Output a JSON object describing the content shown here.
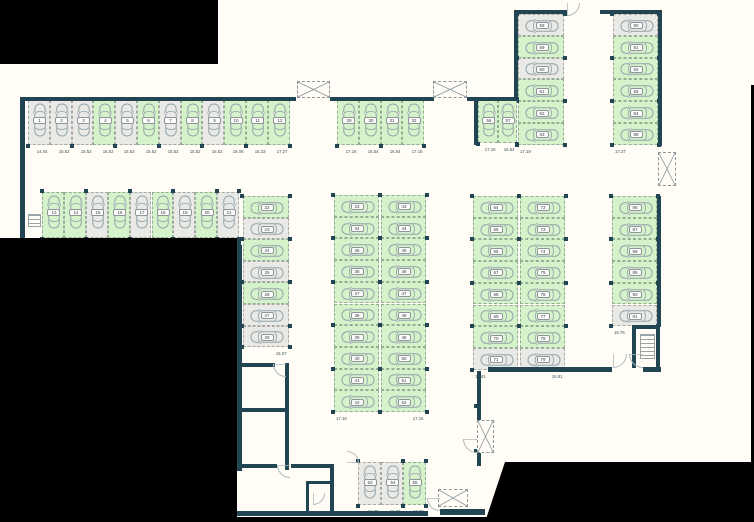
{
  "meta": {
    "canvas_w": 754,
    "canvas_h": 522,
    "description": "underground parking level floor plan"
  },
  "palette": {
    "background": "#fffdf5",
    "wall": "#214552",
    "stall_available_fill": "#d6f2cb",
    "stall_available_border": "#92ae95",
    "stall_taken_fill": "#e9eae6",
    "stall_taken_border": "#a9aaa7",
    "car_outline": "#94a3a9",
    "dimension_text": "#41535d",
    "mask": "#000000"
  },
  "icons": [
    "car-icon",
    "shaft-x-icon",
    "stairs-icon",
    "door-swing-icon"
  ],
  "plan": {
    "groups": [
      {
        "name": "row-1-12",
        "dir": "row",
        "x": 28,
        "y": 100,
        "pitch": 21.8,
        "len": 45,
        "vpos": "b",
        "stalls": [
          [
            "1",
            "14.04",
            0
          ],
          [
            "2",
            "15.52",
            0
          ],
          [
            "3",
            "15.52",
            0
          ],
          [
            "4",
            "15.52",
            1
          ],
          [
            "5",
            "15.52",
            0
          ],
          [
            "6",
            "15.52",
            1
          ],
          [
            "7",
            "15.52",
            0
          ],
          [
            "8",
            "15.52",
            1
          ],
          [
            "9",
            "15.52",
            0
          ],
          [
            "10",
            "16.06",
            1
          ],
          [
            "11",
            "16.33",
            1
          ],
          [
            "12",
            "17.27",
            1
          ]
        ]
      },
      {
        "name": "row-29-32",
        "dir": "row",
        "x": 337,
        "y": 100,
        "pitch": 21.8,
        "len": 45,
        "vpos": "b",
        "stalls": [
          [
            "29",
            "17.16",
            1
          ],
          [
            "30",
            "16.54",
            1
          ],
          [
            "31",
            "16.54",
            1
          ],
          [
            "32",
            "17.16",
            1
          ]
        ]
      },
      {
        "name": "row-13-21",
        "dir": "row",
        "x": 42,
        "y": 192,
        "pitch": 21.9,
        "len": 46,
        "vpos": "b",
        "stalls": [
          [
            "13",
            "20.27",
            1
          ],
          [
            "14",
            "16.67",
            1
          ],
          [
            "15",
            "16.67",
            0
          ],
          [
            "16",
            "16.67",
            1
          ],
          [
            "17",
            "16.67",
            0
          ],
          [
            "18",
            "16.67",
            1
          ],
          [
            "19",
            "16.67",
            0
          ],
          [
            "20",
            "16.67",
            1
          ],
          [
            "21",
            "16.67",
            0
          ]
        ]
      },
      {
        "name": "col-22-28",
        "dir": "col",
        "x": 243,
        "y": 196,
        "pitch": 21.6,
        "len": 46,
        "vpos": "br",
        "stalls": [
          [
            "22",
            "17.16",
            1
          ],
          [
            "23",
            "16.00",
            0
          ],
          [
            "24",
            "16.67",
            1
          ],
          [
            "25",
            "16.67",
            0
          ],
          [
            "26",
            "16.67",
            1
          ],
          [
            "27",
            "16.67",
            0
          ],
          [
            "28",
            "16.07",
            0
          ]
        ]
      },
      {
        "name": "col-33-42",
        "dir": "col",
        "x": 334,
        "y": 195,
        "pitch": 21.7,
        "len": 45,
        "vpos": "bl",
        "stalls": [
          [
            "33",
            "17.16",
            1
          ],
          [
            "34",
            "16.12",
            1
          ],
          [
            "35",
            "16.12",
            1
          ],
          [
            "36",
            "16.12",
            1
          ],
          [
            "37",
            "16.12",
            1
          ],
          [
            "38",
            "16.12",
            1
          ],
          [
            "39",
            "16.12",
            1
          ],
          [
            "40",
            "16.12",
            1
          ],
          [
            "41",
            "16.12",
            1
          ],
          [
            "42",
            "17.16",
            1
          ]
        ]
      },
      {
        "name": "col-43-52",
        "dir": "col",
        "x": 381,
        "y": 195,
        "pitch": 21.7,
        "len": 45,
        "vpos": "br",
        "stalls": [
          [
            "43",
            "17.16",
            1
          ],
          [
            "44",
            "16.12",
            1
          ],
          [
            "45",
            "16.12",
            1
          ],
          [
            "46",
            "16.12",
            1
          ],
          [
            "47",
            "16.12",
            1
          ],
          [
            "48",
            "16.12",
            1
          ],
          [
            "49",
            "16.12",
            1
          ],
          [
            "50",
            "16.12",
            1
          ],
          [
            "51",
            "16.12",
            1
          ],
          [
            "52",
            "17.16",
            1
          ]
        ]
      },
      {
        "name": "col-64-71",
        "dir": "col",
        "x": 473,
        "y": 196,
        "pitch": 21.7,
        "len": 45,
        "vpos": "bl",
        "stalls": [
          [
            "64",
            "17.30",
            1
          ],
          [
            "65",
            "16.12",
            1
          ],
          [
            "66",
            "16.12",
            1
          ],
          [
            "67",
            "16.12",
            1
          ],
          [
            "68",
            "16.12",
            1
          ],
          [
            "69",
            "16.12",
            1
          ],
          [
            "70",
            "16.12",
            1
          ],
          [
            "71",
            "16.81",
            0
          ]
        ]
      },
      {
        "name": "col-72-79",
        "dir": "col",
        "x": 520,
        "y": 196,
        "pitch": 21.7,
        "len": 45,
        "vpos": "br",
        "stalls": [
          [
            "72",
            "17.16",
            1
          ],
          [
            "73",
            "16.12",
            1
          ],
          [
            "74",
            "16.12",
            1
          ],
          [
            "75",
            "16.12",
            1
          ],
          [
            "76",
            "16.12",
            1
          ],
          [
            "77",
            "16.12",
            1
          ],
          [
            "78",
            "16.12",
            1
          ],
          [
            "79",
            "16.81",
            0
          ]
        ]
      },
      {
        "name": "col-86-91",
        "dir": "col",
        "x": 612,
        "y": 196,
        "pitch": 21.7,
        "len": 45,
        "vpos": "bl",
        "stalls": [
          [
            "86",
            "17.27",
            1
          ],
          [
            "87",
            "16.53",
            1
          ],
          [
            "88",
            "16.53",
            1
          ],
          [
            "89",
            "16.53",
            1
          ],
          [
            "90",
            "16.25",
            1
          ],
          [
            "91",
            "16.76",
            0
          ]
        ]
      },
      {
        "name": "col-58-63",
        "dir": "col",
        "x": 518,
        "y": 14,
        "pitch": 21.8,
        "len": 46,
        "vpos": "bl",
        "stalls": [
          [
            "58",
            "16.05",
            0
          ],
          [
            "59",
            "16.65",
            1
          ],
          [
            "60",
            "16.27",
            0
          ],
          [
            "61",
            "16.33",
            1
          ],
          [
            "62",
            "16.12",
            1
          ],
          [
            "63",
            "17.19",
            1
          ]
        ]
      },
      {
        "name": "col-80-85",
        "dir": "col",
        "x": 613,
        "y": 14,
        "pitch": 21.8,
        "len": 45,
        "vpos": "bl",
        "stalls": [
          [
            "80",
            "16.79",
            0
          ],
          [
            "81",
            "16.53",
            1
          ],
          [
            "82",
            "16.53",
            1
          ],
          [
            "83",
            "16.53",
            1
          ],
          [
            "84",
            "16.53",
            1
          ],
          [
            "85",
            "17.27",
            1
          ]
        ]
      },
      {
        "name": "row-56-57",
        "dir": "row",
        "x": 478,
        "y": 100,
        "pitch": 19.5,
        "len": 43,
        "vpos": "b",
        "stalls": [
          [
            "56",
            "17.16",
            1
          ],
          [
            "57",
            "16.54",
            1
          ]
        ]
      },
      {
        "name": "row-53-55",
        "dir": "row",
        "x": 358,
        "y": 462,
        "pitch": 22.5,
        "len": 43,
        "vpos": "b",
        "stalls": [
          [
            "53",
            "16.00",
            0
          ],
          [
            "54",
            "16.00",
            0
          ],
          [
            "55",
            "17.00",
            1
          ]
        ]
      }
    ],
    "walls": [
      [
        20,
        97,
        276,
        4
      ],
      [
        20,
        97,
        5,
        150
      ],
      [
        25,
        240,
        216,
        5
      ],
      [
        237,
        245,
        5,
        226
      ],
      [
        330,
        97,
        104,
        4
      ],
      [
        467,
        97,
        51,
        4
      ],
      [
        474,
        97,
        4,
        48
      ],
      [
        514,
        10,
        4,
        88
      ],
      [
        514,
        10,
        53,
        4
      ],
      [
        600,
        10,
        62,
        4
      ],
      [
        658,
        10,
        4,
        136
      ],
      [
        657,
        196,
        4,
        131
      ],
      [
        632,
        325,
        4,
        43
      ],
      [
        632,
        325,
        28,
        4
      ],
      [
        656,
        325,
        4,
        43
      ],
      [
        488,
        367,
        124,
        5
      ],
      [
        643,
        367,
        18,
        5
      ],
      [
        477,
        371,
        4,
        67
      ],
      [
        477,
        453,
        4,
        13
      ],
      [
        440,
        509,
        45,
        6
      ],
      [
        233,
        511,
        195,
        5
      ],
      [
        237,
        363,
        38,
        4
      ],
      [
        237,
        408,
        52,
        4
      ],
      [
        285,
        363,
        4,
        107
      ],
      [
        233,
        464,
        44,
        4
      ],
      [
        291,
        464,
        42,
        4
      ],
      [
        330,
        464,
        4,
        51
      ],
      [
        306,
        481,
        27,
        3
      ],
      [
        306,
        481,
        3,
        33
      ]
    ],
    "extra_posts": [
      [
        474,
        404
      ],
      [
        474,
        449
      ],
      [
        236,
        304
      ],
      [
        236,
        348
      ],
      [
        236,
        412
      ],
      [
        236,
        460
      ]
    ],
    "xboxes": [
      [
        297,
        81,
        33,
        17
      ],
      [
        433,
        81,
        34,
        17
      ],
      [
        658,
        152,
        18,
        34
      ],
      [
        477,
        420,
        17,
        33
      ],
      [
        438,
        489,
        30,
        18
      ]
    ],
    "arcs": [
      [
        567,
        3,
        13,
        "tl"
      ],
      [
        273,
        364,
        13,
        "tr"
      ],
      [
        277,
        465,
        13,
        "tr"
      ],
      [
        313,
        492,
        12,
        "tl"
      ],
      [
        346,
        451,
        12,
        "bl"
      ],
      [
        427,
        498,
        13,
        "tr"
      ],
      [
        613,
        354,
        14,
        "tl"
      ],
      [
        629,
        354,
        14,
        "tr"
      ],
      [
        463,
        439,
        14,
        "tr"
      ]
    ],
    "stairs": [
      [
        640,
        334,
        15,
        25
      ],
      [
        28,
        214,
        13,
        13
      ]
    ],
    "masks": {
      "rects": [
        [
          0,
          0,
          218,
          64
        ],
        [
          0,
          238,
          237,
          284
        ],
        [
          751,
          85,
          3,
          380
        ],
        [
          0,
          517,
          490,
          5
        ]
      ],
      "polygon": "505px 462px,754px 462px,754px 522px,485px 522px"
    }
  }
}
